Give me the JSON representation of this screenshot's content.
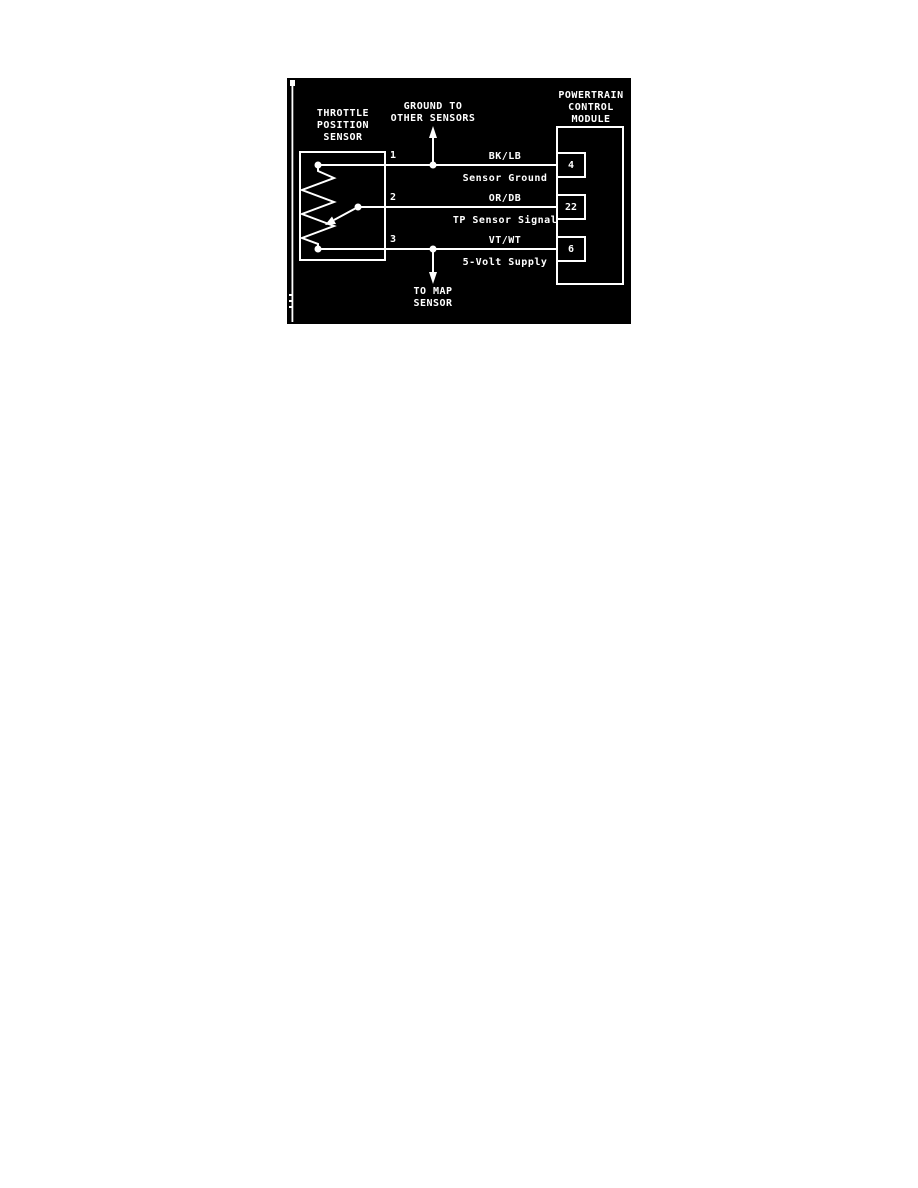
{
  "page": {
    "background": "#ffffff"
  },
  "diagram": {
    "background": "#000000",
    "line_color": "#ffffff",
    "tps": {
      "title": "THROTTLE\nPOSITION\nSENSOR"
    },
    "pcm": {
      "title": "POWERTRAIN\nCONTROL\nMODULE"
    },
    "ground_branch": {
      "label": "GROUND TO\nOTHER SENSORS"
    },
    "map_branch": {
      "label": "TO MAP\nSENSOR"
    },
    "wires": [
      {
        "tps_pin": "1",
        "wire_color": "BK/LB",
        "signal": "Sensor Ground",
        "pcm_pin": "4"
      },
      {
        "tps_pin": "2",
        "wire_color": "OR/DB",
        "signal": "TP Sensor Signal",
        "pcm_pin": "22"
      },
      {
        "tps_pin": "3",
        "wire_color": "VT/WT",
        "signal": "5-Volt Supply",
        "pcm_pin": "6"
      }
    ]
  }
}
